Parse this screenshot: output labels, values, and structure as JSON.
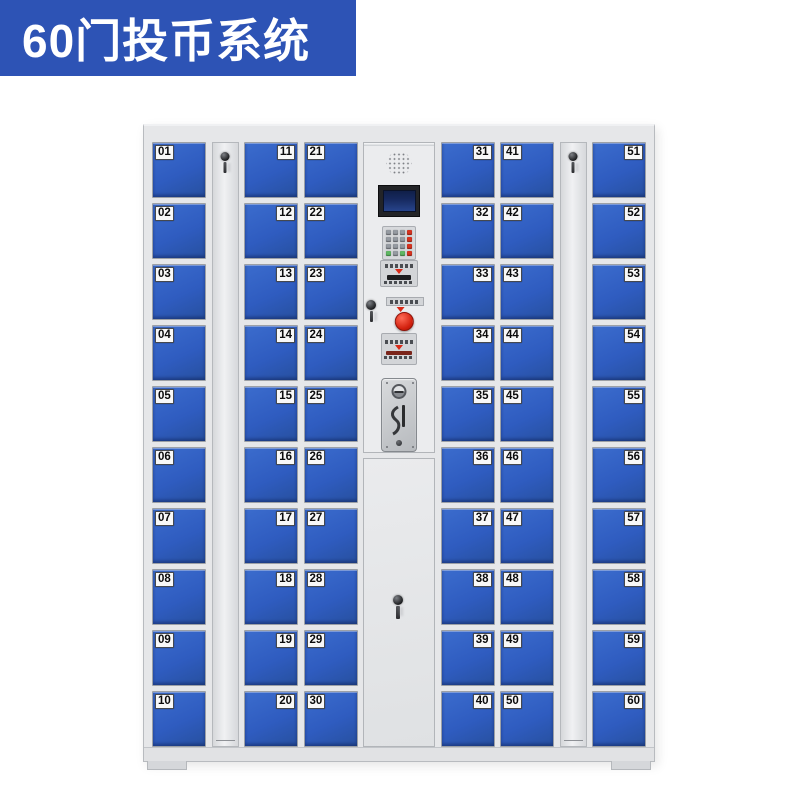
{
  "banner": {
    "title": "60门投币系统"
  },
  "cabinet": {
    "columns": [
      {
        "type": "doors",
        "name": "door-column-01-10",
        "label_side": "left",
        "doors": [
          "01",
          "02",
          "03",
          "04",
          "05",
          "06",
          "07",
          "08",
          "09",
          "10"
        ]
      },
      {
        "type": "panel",
        "name": "left-lock-panel"
      },
      {
        "type": "doors",
        "name": "door-column-11-20",
        "label_side": "right",
        "doors": [
          "11",
          "12",
          "13",
          "14",
          "15",
          "16",
          "17",
          "18",
          "19",
          "20"
        ]
      },
      {
        "type": "doors",
        "name": "door-column-21-30",
        "label_side": "left",
        "doors": [
          "21",
          "22",
          "23",
          "24",
          "25",
          "26",
          "27",
          "28",
          "29",
          "30"
        ]
      },
      {
        "type": "control",
        "name": "control-column"
      },
      {
        "type": "doors",
        "name": "door-column-31-40",
        "label_side": "right",
        "doors": [
          "31",
          "32",
          "33",
          "34",
          "35",
          "36",
          "37",
          "38",
          "39",
          "40"
        ]
      },
      {
        "type": "doors",
        "name": "door-column-41-50",
        "label_side": "left",
        "doors": [
          "41",
          "42",
          "43",
          "44",
          "45",
          "46",
          "47",
          "48",
          "49",
          "50"
        ]
      },
      {
        "type": "panel",
        "name": "right-lock-panel"
      },
      {
        "type": "doors",
        "name": "door-column-51-60",
        "label_side": "right",
        "doors": [
          "51",
          "52",
          "53",
          "54",
          "55",
          "56",
          "57",
          "58",
          "59",
          "60"
        ]
      }
    ]
  },
  "control_panel": {
    "keypad_rows": [
      [
        "gray",
        "gray",
        "gray",
        "red"
      ],
      [
        "gray",
        "gray",
        "gray",
        "red"
      ],
      [
        "gray",
        "gray",
        "gray",
        "red"
      ],
      [
        "green",
        "gray",
        "green",
        "red"
      ]
    ]
  },
  "colors": {
    "banner_bg": "#2d53b5",
    "banner_fg": "#ffffff",
    "door_blue": "#2f5cc0",
    "door_blue_light": "#3b6ccd",
    "door_blue_dark": "#27509f",
    "cabinet_body": "#e6e7e9",
    "panel_face": "#ebecee",
    "label_bg": "#f8f8f8",
    "label_fg": "#0b0b0c",
    "key_gray": "#959aa1",
    "key_red": "#d63320",
    "key_green": "#5fb763",
    "button_red": "#d2200e",
    "lcd_navy": "#16295e"
  }
}
